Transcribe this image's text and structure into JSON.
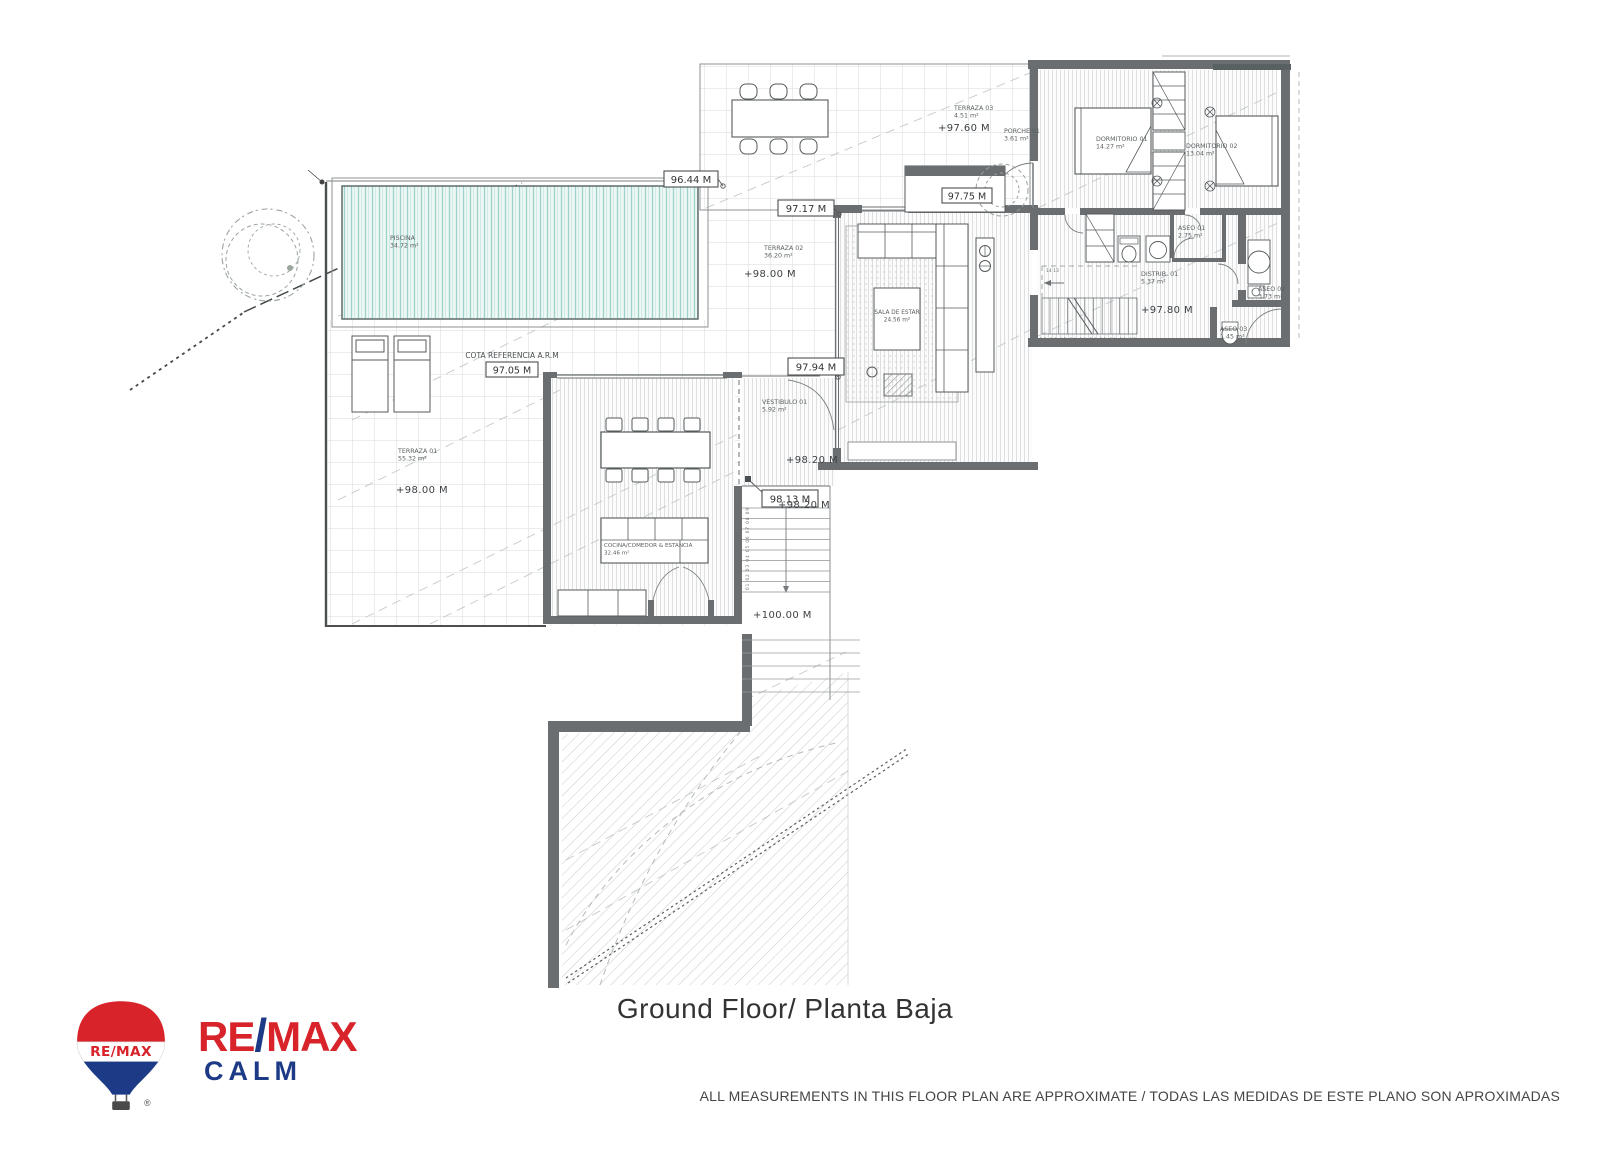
{
  "page": {
    "title": "Ground Floor/ Planta Baja",
    "disclaimer": "ALL MEASUREMENTS IN THIS FLOOR PLAN ARE APPROXIMATE / TODAS LAS MEDIDAS DE ESTE PLANO SON APROXIMADAS"
  },
  "logo": {
    "re": "RE",
    "slash": "/",
    "max": "MAX",
    "office": "CALM",
    "balloon_label": "RE/MAX",
    "registered": "®",
    "colors": {
      "red": "#d8232a",
      "blue": "#1d3a87"
    }
  },
  "plan": {
    "reference_note": "COTA REFERENCIA A.R.M",
    "rooms": [
      {
        "name": "PISCINA",
        "area": "34.72 m²"
      },
      {
        "name": "TERRAZA 01",
        "area": "55.32 m²"
      },
      {
        "name": "TERRAZA 02",
        "area": "36.20 m²"
      },
      {
        "name": "TERRAZA 03",
        "area": "4.51 m²"
      },
      {
        "name": "PORCHE 01",
        "area": "3.61 m²"
      },
      {
        "name": "DORMITORIO 01",
        "area": "14.27 m²"
      },
      {
        "name": "DORMITORIO 02",
        "area": "13.04 m²"
      },
      {
        "name": "SALA DE ESTAR",
        "area": "24.56 m²"
      },
      {
        "name": "VESTIBULO 01",
        "area": "5.92 m²"
      },
      {
        "name": "COCINA/COMEDOR & ESTANCIA",
        "area": "32.46 m²"
      },
      {
        "name": "DISTRIB. 01",
        "area": "5.37 m²"
      },
      {
        "name": "ASEO 01",
        "area": "2.75 m²"
      },
      {
        "name": "ASEO 02",
        "area": "3.73 m²"
      },
      {
        "name": "ASEO 03",
        "area": "1.45 m²"
      }
    ],
    "elevation_boxes": [
      "96.44 M",
      "97.05 M",
      "97.17 M",
      "97.75 M",
      "97.94 M",
      "98.13 M"
    ],
    "elevation_marks": [
      "+97.60 M",
      "+98.00 M",
      "+98.00 M",
      "+98.20 M",
      "+98.20 M",
      "+97.80 M",
      "+100.00 M"
    ],
    "stair_numbers": {
      "interior_upper": "14  13",
      "interior_lower": "15 16 17 18 19 20 21 10 11 12",
      "exterior_upper": "01 02 03 04 05 06 07 08 09",
      "exterior_lower": "12 11 10"
    }
  }
}
